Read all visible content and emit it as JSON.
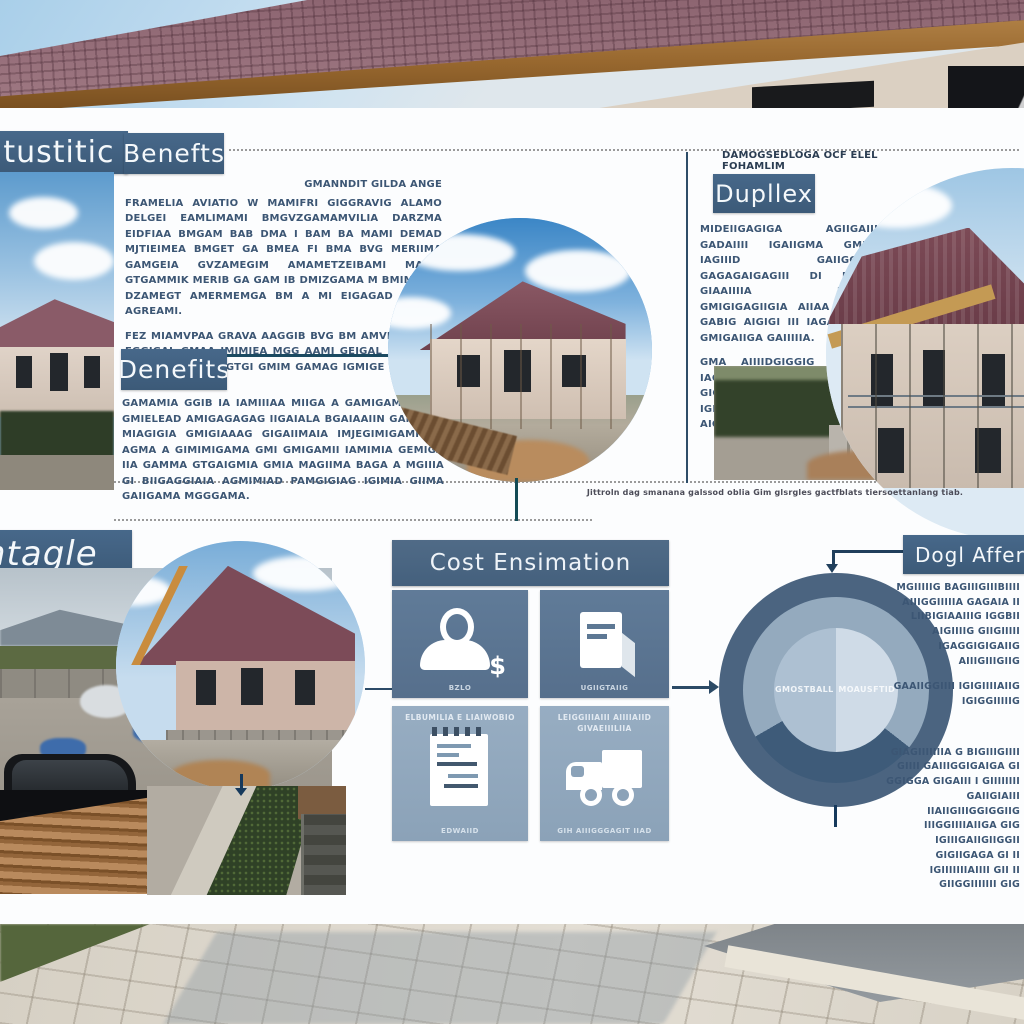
{
  "poster": {
    "left_top": {
      "title": "nitustitic"
    },
    "benefits": {
      "title": "Benefts",
      "intro": "GMANNDIT GILDA ANGE",
      "p1": "FRAMELIA AVIATIO W MAMIFRI GIGGRAVIG ALAMO DELGEI EAMLIMAMI BMGVZGAMAMVILIA DARZMA EIDFIAA BMGAM BAB DMA I BAM BA MAMI DEMAD MJTIEIMEA BMGET GA BMEA FI BMA BVG MERIIMA GAMGEIA GVZAMEGIM AMAMETZEIBAMI MAJER GTGAMMIK MERIB GA GAM IB DMIZGAMA M BMIMA GA DZAMEGT AMERMEMGA BM A MI EIGAGAD GTAMA AGREAMI.",
      "p2": "FEZ MIAMVPAA GRAVA AAGGIB BVG BM AMVMAIL IMA EGGIGAL GMAA IMIMJEA MGG AAMI GEIGAL DETEGGG GIMI MIAGIM GA GTGI GMIM GAMAG IGMIGE MIGAGIM DIBAGI GEILAGD."
    },
    "denefits": {
      "title": "Denefits",
      "p1": "GAMAMIA GGIB IA IAMIIIAA MIIGA A GAMIGAMA GAID GMIELEAD AMIGAGAGAG IIGAIALA BGAIAAIIN GAMGAIA MIAGIGIA GMIGIAAAG GIGAIIMAIA IMJEGIMIGAMI IIA AGMA A GIMIMIGAMA GMI GMIGAMII IAMIMIA GEMIGA IIA GAMMA GTGAIGMIA GMIA MAGIIMA BAGA A MGIIIA GI BIIGAGGIAIA AGMIMIAD PAMGIGIAG IGIMIA GIIMA GAIIGAMA MGGGAMA."
    },
    "duplex": {
      "overline": "DAMOGSEDLOGA OCF ELEL FOHAMLIM",
      "title": "Dupllex",
      "p1": "MIDEIIGAGIGA AGIIGAIII GADAIIII IGAIIGMA GMIIA IAGIIID GAIIGGIGA GAGAGAIGAGIII DI BAGIA GIAAIIIIA IGGIGA GMIGIGAGIIGIA AIIAA IGA A GABIG AIGIGI III IAGA BAIIID GMIGAIIGA GAIIIIIA.",
      "p2": "GMA AIIIIDGIGGIG GIIGADII IAGAGIIIIGA AIIGIIDA GAIA GIGGIIII AIIIGA GI GAGIIIGAIGA IGIIIIGG GIIIGIIIG GIGAIA AIGIGGIIGG GIIGGA.",
      "caption": "Jittroln dag smanana galssod oblia Gim glsrgles gactfblats tiersoettanlang tiab."
    },
    "vintage": {
      "title": "ntagle"
    },
    "cost": {
      "title": "Cost Ensimation",
      "tiles": [
        {
          "label_top": "",
          "label_bottom": "BZLO",
          "icon": "person-dollar-icon",
          "dollar_sign": "$"
        },
        {
          "label_top": "",
          "label_bottom": "UGIIGTAIIG",
          "icon": "document-icon"
        },
        {
          "label_top": "ELBUMILIA E LIAIWOBIO",
          "label_bottom": "EDWAIID",
          "icon": "notepad-icon"
        },
        {
          "label_top": "LEIGGIIIAIII AIIIIAIID GIVAEIIILIIA",
          "label_bottom": "GIH AIIIGGGAGIT IIAD",
          "icon": "truck-icon"
        }
      ]
    },
    "donut": {
      "label_left": "GMOSTBALL",
      "label_right": "MOAUSFTID"
    },
    "dogl": {
      "title": "Dogl Afferca",
      "p1": "MGIIIIIG BAGIIIGIIIBIIII AIIIGGIIIIIA GAGAIA II LIIBIGIAAIIIG IGGBII AIGIIIIG GIIGIIIII IGAGGIGIGAIIG AIIIGIIIGIIG",
      "p2": "GAAIIGGIIII IGIGIIIIAIIG IGIGGIIIIIG",
      "p3": "GIAGIIIIIIIA G BIGIIIGIIII GIIII GAIIIGGIGAIGA GI GGIGGA GIGAIII I GIIIIIIII GAIIGIAIII IIAIIGIIIGGIGGIIG IIIGGIIIIAIIGA GIG IGIIIGAIIGIIGGII GIGIIGAGA GI II IGIIIIIIIAIIII GII II GIIGGIIIIIII GIG"
    },
    "colors": {
      "banner_blue": "#3f5f7c",
      "tile_dark_blue": "#5d7894",
      "tile_light_blue": "#93a9bf",
      "donut_outer": "#4b6480",
      "donut_ring": "#94aabe",
      "donut_wedge": "#3e5b79",
      "donut_inner_left": "#adc0d2",
      "donut_inner_right": "#cfdbe7",
      "body_text": "#3c5674"
    }
  },
  "chart_data": {
    "type": "pie",
    "title": "",
    "labels": [
      "GMOSTBALL",
      "MOAUSFTID"
    ],
    "values": [
      50,
      50
    ],
    "outer_ring_wedge_percent": 31,
    "legend_position": "none"
  }
}
